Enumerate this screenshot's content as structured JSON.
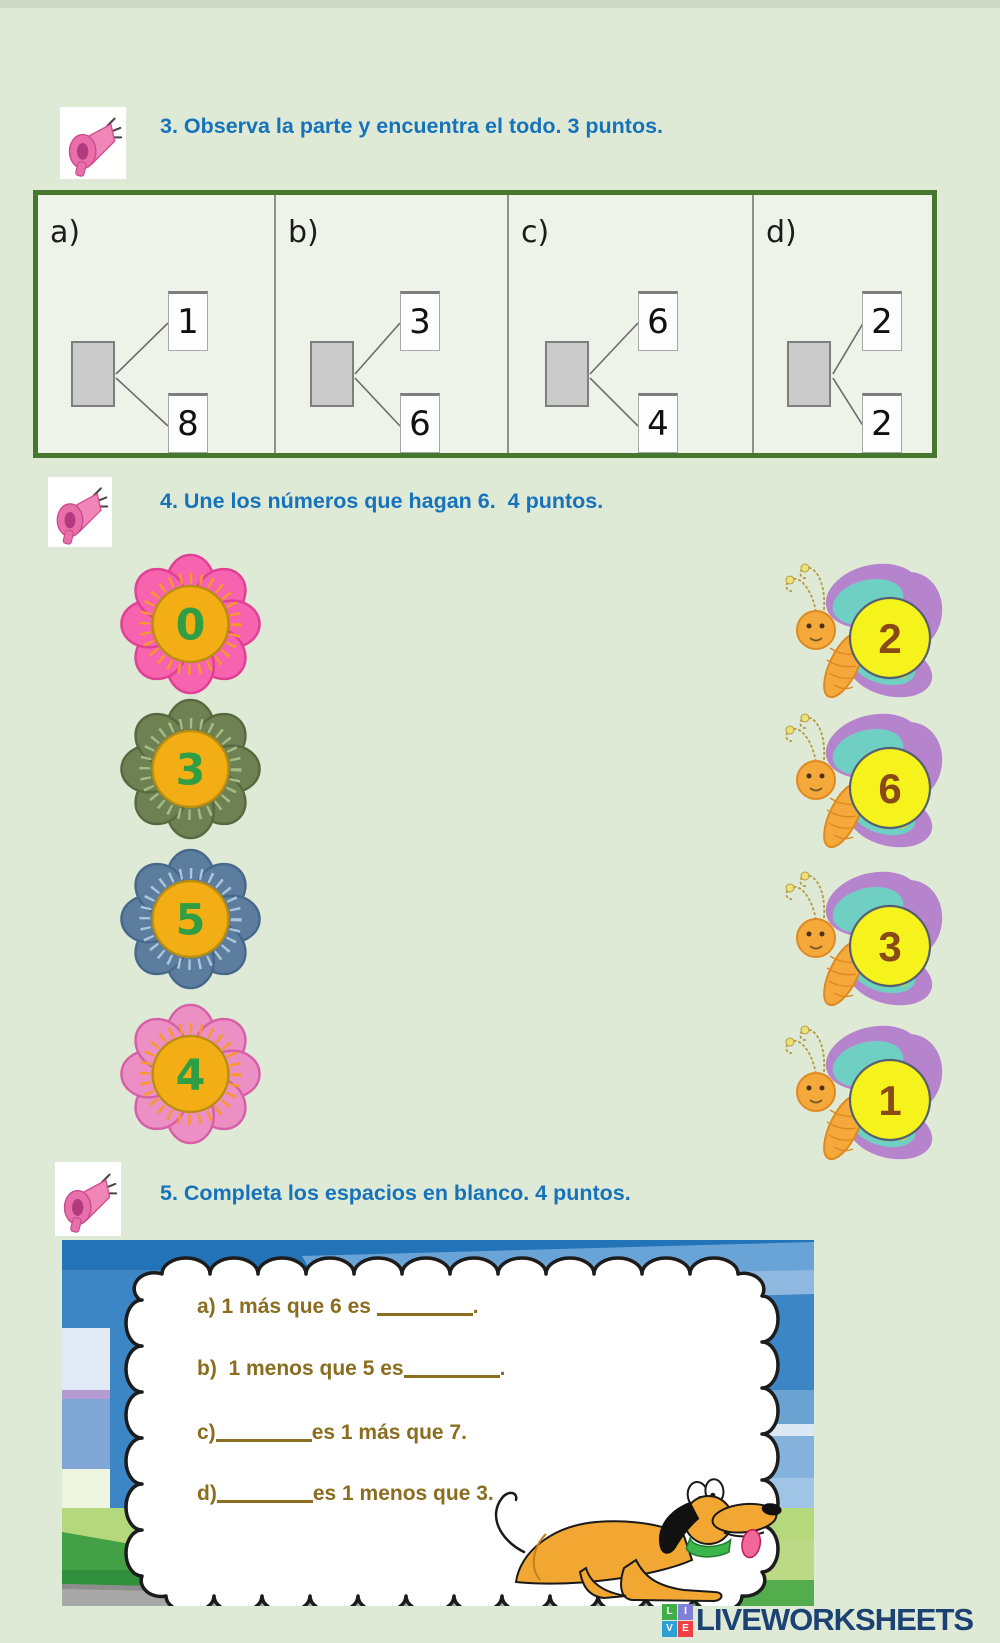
{
  "colors": {
    "page-bg": "#dfead6",
    "top-strip": "#ccd7c5",
    "heading": "#1673bb",
    "answer": "#8a6d1e",
    "bond-border": "#47762f",
    "bond-bg": "#eef3ea",
    "bond-sep": "#8c9383",
    "flower-center": "#f3ae15",
    "flower-center-edge": "#b98e10",
    "flower-num": "#2f9e44",
    "wing-outer": "#b684cc",
    "wing-band": "#6fcfc3",
    "wing-pink": "#f2a6c6",
    "wing-dot": "#c7d84e",
    "bug-body": "#f6a93b",
    "bug-edge": "#dd8a22",
    "num-circle": "#f6f31c",
    "num-circle-edge": "#55606e",
    "num-brown": "#8a4a15",
    "logo-navy": "#1b4273"
  },
  "section3": {
    "icon": "megaphone",
    "title": "3. Observa la parte y encuentra el todo. 3 puntos.",
    "bonds": [
      {
        "label": "a)",
        "top": "1",
        "bottom": "8"
      },
      {
        "label": "b)",
        "top": "3",
        "bottom": "6"
      },
      {
        "label": "c)",
        "top": "6",
        "bottom": "4"
      },
      {
        "label": "d)",
        "top": "2",
        "bottom": "2"
      }
    ]
  },
  "section4": {
    "icon": "megaphone",
    "title": "4. Une los números que hagan 6.  4 puntos.",
    "flowers": [
      {
        "value": "0",
        "petal": "#f763ae",
        "edge": "#e03f95",
        "dash": "#f59a2a"
      },
      {
        "value": "3",
        "petal": "#6d8153",
        "edge": "#59693f",
        "dash": "#a4bd84"
      },
      {
        "value": "5",
        "petal": "#5c7d9d",
        "edge": "#47688c",
        "dash": "#a9c6dc"
      },
      {
        "value": "4",
        "petal": "#ec8fc4",
        "edge": "#d560a8",
        "dash": "#f59a2a"
      }
    ],
    "butterflies": [
      {
        "value": "2"
      },
      {
        "value": "6"
      },
      {
        "value": "3"
      },
      {
        "value": "1"
      }
    ]
  },
  "section5": {
    "icon": "megaphone",
    "title": "5. Completa los espacios en blanco. 4 puntos.",
    "items": [
      {
        "before": "a) 1 más que 6 es ",
        "after": "."
      },
      {
        "before": "b)  1 menos que 5 es",
        "after": "."
      },
      {
        "before": "c)",
        "after": "es 1 más que 7."
      },
      {
        "before": "d)",
        "after": "es 1 menos que 3."
      }
    ]
  },
  "footer": {
    "logo_text": "LIVEWORKSHEETS",
    "logo_squares": [
      {
        "ch": "L",
        "bg": "#3fae49"
      },
      {
        "ch": "I",
        "bg": "#8080d7"
      },
      {
        "ch": "V",
        "bg": "#2e9fd4"
      },
      {
        "ch": "E",
        "bg": "#ef4043"
      }
    ]
  }
}
